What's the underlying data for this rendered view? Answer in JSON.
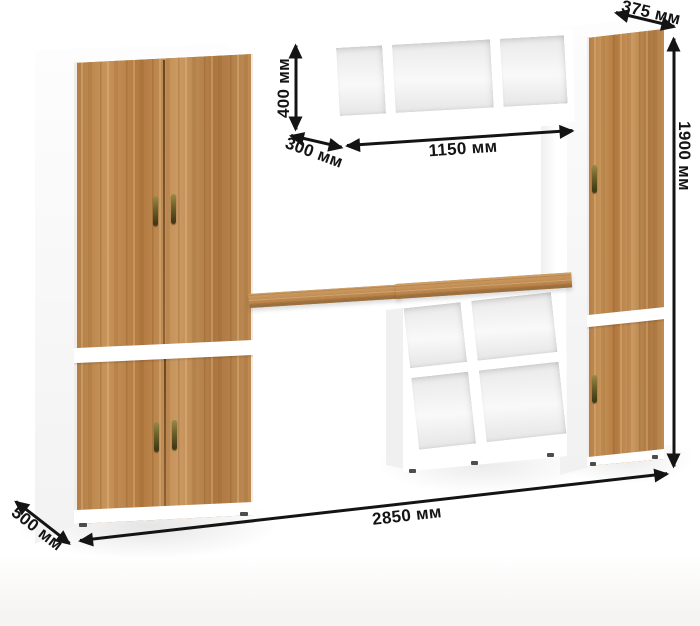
{
  "dimensions": {
    "hutch_height": "400 мм",
    "hutch_depth": "300 мм",
    "hutch_width": "1150 мм",
    "column_top_depth": "375 мм",
    "column_height": "1900 мм",
    "total_width": "2850 мм",
    "cabinet_depth": "500 мм"
  },
  "colors": {
    "wood": "#bd8950",
    "carcass_white": "#ffffff",
    "dimension_line": "#141414",
    "handle_brass": "#6a5e28"
  }
}
